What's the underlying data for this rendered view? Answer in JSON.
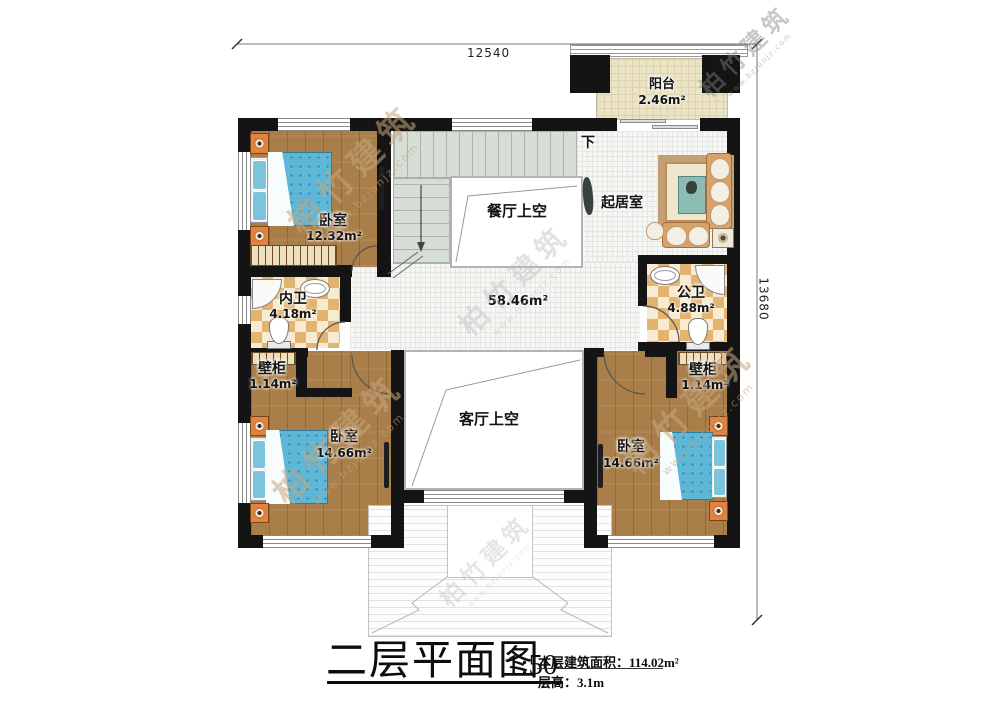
{
  "plan": {
    "dimensions": {
      "width": "12540",
      "height": "13680"
    },
    "rooms": {
      "balcony": {
        "name": "阳台",
        "area": "2.46m²"
      },
      "bedroom_top_left": {
        "name": "卧室",
        "area": "12.32m²"
      },
      "private_bath": {
        "name": "内卫",
        "area": "4.18m²"
      },
      "public_bath": {
        "name": "公卫",
        "area": "4.88m²"
      },
      "closet_left": {
        "name": "壁柜",
        "area": "1.14m²"
      },
      "closet_right": {
        "name": "壁柜",
        "area": "1.14m²"
      },
      "bedroom_bottom_left": {
        "name": "卧室",
        "area": "14.66m²"
      },
      "bedroom_bottom_right": {
        "name": "卧室",
        "area": "14.66m²"
      },
      "dining_void": {
        "name": "餐厅上空"
      },
      "living_void": {
        "name": "客厅上空"
      },
      "sitting_room": {
        "name": "起居室"
      },
      "hall": {
        "area": "58.46m²"
      },
      "stairs": {
        "down": "下"
      }
    },
    "title_block": {
      "title": "二层平面图",
      "scale": "1:50",
      "floor_area_label": "本层建筑面积：",
      "floor_area_value": "114.02m²",
      "floor_height_label": "层高：",
      "floor_height_value": "3.1m"
    },
    "watermark": {
      "brand": "柏竹建筑",
      "site": "www.bzjunjz.com"
    },
    "colors": {
      "wall": "#141414",
      "wood_floor": "#a97e48",
      "bed": "#5fb7d7",
      "bath_tile": "#e2b470",
      "stair": "#d6ded6",
      "balcony_floor": "#ebe3c6",
      "sofa": "#d9a268"
    }
  }
}
